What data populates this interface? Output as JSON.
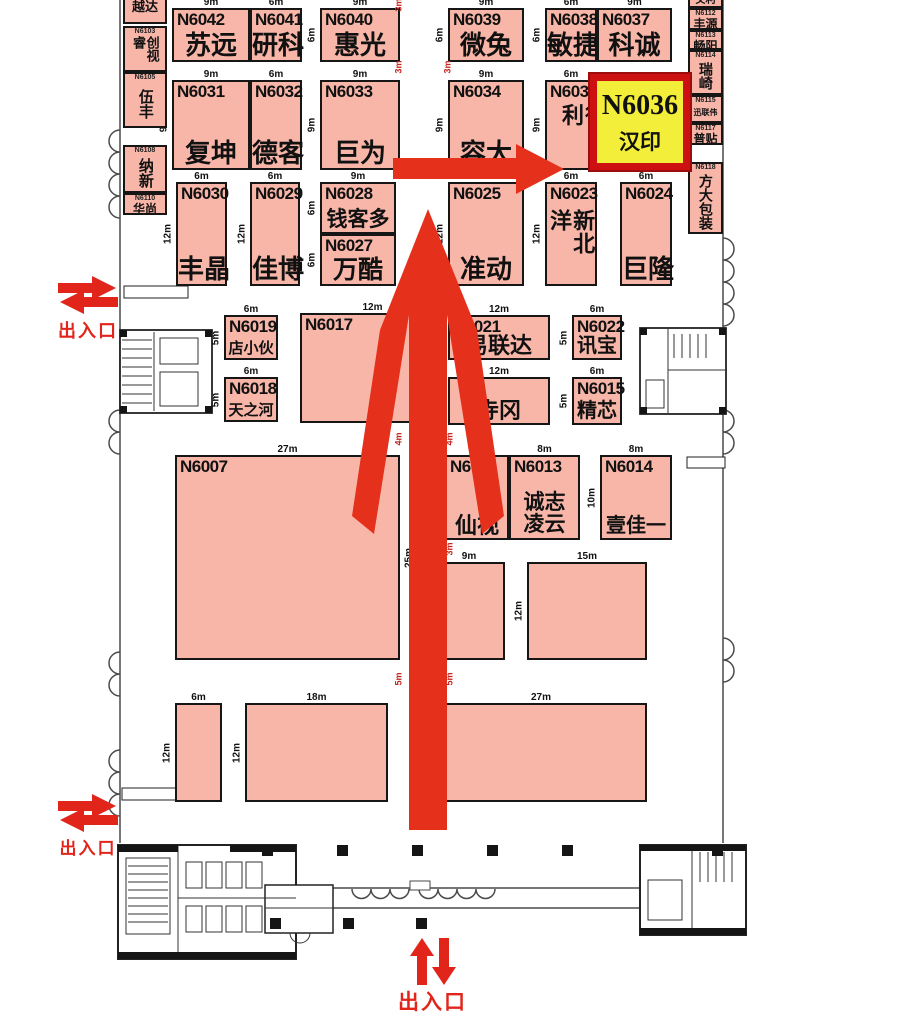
{
  "colors": {
    "booth_fill": "#f8b6a9",
    "booth_border": "#161616",
    "highlight_fill": "#f3ee39",
    "highlight_border": "#cd1111",
    "route_arrow": "#e5301b",
    "entrance_red": "#e1251b",
    "aisle_dim_red": "#c2231d",
    "dim_black": "#111111"
  },
  "highlight_booth": {
    "num": "N6036",
    "name": "汉印",
    "x": 590,
    "y": 74,
    "w": 100,
    "h": 96
  },
  "booths": [
    {
      "num": "N6042",
      "name": "苏远",
      "x": 172,
      "y": 8,
      "w": 78,
      "h": 54,
      "dw": "9m",
      "dh": "6m",
      "fs": 26
    },
    {
      "num": "N6041",
      "name": "研科",
      "x": 250,
      "y": 8,
      "w": 52,
      "h": 54,
      "dw": "6m",
      "fs": 26
    },
    {
      "num": "N6040",
      "name": "惠光",
      "x": 320,
      "y": 8,
      "w": 80,
      "h": 54,
      "dw": "9m",
      "dh": "6m",
      "fs": 26
    },
    {
      "num": "N6039",
      "name": "微兔",
      "x": 448,
      "y": 8,
      "w": 76,
      "h": 54,
      "dw": "9m",
      "dh": "6m",
      "fs": 26
    },
    {
      "num": "N6038",
      "name": "敏捷",
      "x": 545,
      "y": 8,
      "w": 52,
      "h": 54,
      "dw": "6m",
      "dh": "6m",
      "fs": 26
    },
    {
      "num": "N6037",
      "name": "科诚",
      "x": 597,
      "y": 8,
      "w": 75,
      "h": 54,
      "dw": "9m",
      "fs": 26
    },
    {
      "num": "N6031",
      "name": "复坤",
      "x": 172,
      "y": 80,
      "w": 78,
      "h": 90,
      "dw": "9m",
      "dh": "9m",
      "fs": 26
    },
    {
      "num": "N6032",
      "name": "德客",
      "x": 250,
      "y": 80,
      "w": 52,
      "h": 90,
      "dw": "6m",
      "fs": 26
    },
    {
      "num": "N6033",
      "name": "巨为",
      "x": 320,
      "y": 80,
      "w": 80,
      "h": 90,
      "dw": "9m",
      "dh": "9m",
      "fs": 26
    },
    {
      "num": "N6034",
      "name": "容大",
      "x": 448,
      "y": 80,
      "w": 76,
      "h": 90,
      "dw": "9m",
      "dh": "9m",
      "fs": 26
    },
    {
      "num": "N6035",
      "name": "得利",
      "x": 545,
      "y": 80,
      "w": 52,
      "h": 90,
      "dw": "6m",
      "dh": "9m",
      "fs": 22,
      "mode": "v",
      "shift": 12
    },
    {
      "num": "N6030",
      "name": "丰晶",
      "x": 176,
      "y": 182,
      "w": 51,
      "h": 104,
      "dw": "6m",
      "dh": "12m",
      "fs": 26
    },
    {
      "num": "N6029",
      "name": "佳博",
      "x": 250,
      "y": 182,
      "w": 50,
      "h": 104,
      "dw": "6m",
      "dh": "12m",
      "fs": 26
    },
    {
      "num": "N6028",
      "name": "钱客多",
      "x": 320,
      "y": 182,
      "w": 76,
      "h": 52,
      "dw": "9m",
      "dh": "6m",
      "fs": 21
    },
    {
      "num": "N6027",
      "name": "万酷",
      "x": 320,
      "y": 234,
      "w": 76,
      "h": 52,
      "dh": "6m",
      "fs": 25
    },
    {
      "num": "N6025",
      "name": "准动",
      "x": 448,
      "y": 182,
      "w": 76,
      "h": 104,
      "dw": "9m",
      "dh": "12m",
      "fs": 26
    },
    {
      "num": "N6023",
      "name": "新北洋",
      "x": 545,
      "y": 182,
      "w": 52,
      "h": 104,
      "dw": "6m",
      "dh": "12m",
      "fs": 22,
      "mode": "v"
    },
    {
      "num": "N6024",
      "name": "巨隆",
      "x": 620,
      "y": 182,
      "w": 52,
      "h": 104,
      "dw": "6m",
      "fs": 26
    },
    {
      "num": "N6019",
      "name": "店小伙",
      "x": 224,
      "y": 315,
      "w": 54,
      "h": 45,
      "dw": "6m",
      "dh": "5m",
      "fs": 15,
      "ns": 15
    },
    {
      "num": "N6018",
      "name": "天之河",
      "x": 224,
      "y": 377,
      "w": 54,
      "h": 45,
      "dw": "6m",
      "dh": "5m",
      "fs": 15,
      "ns": 15
    },
    {
      "num": "N6017",
      "name": "",
      "x": 300,
      "y": 313,
      "w": 145,
      "h": 110,
      "dw": "12m"
    },
    {
      "num": "N6021",
      "name": "易联达",
      "x": 448,
      "y": 315,
      "w": 102,
      "h": 45,
      "dw": "12m",
      "fs": 22
    },
    {
      "num": "N6022",
      "name": "讯宝",
      "x": 572,
      "y": 315,
      "w": 50,
      "h": 45,
      "dw": "6m",
      "dh": "5m",
      "fs": 20
    },
    {
      "num": "",
      "name": "寺冈",
      "x": 448,
      "y": 377,
      "w": 102,
      "h": 48,
      "dw": "12m",
      "fs": 22
    },
    {
      "num": "N6015",
      "name": "精芯",
      "x": 572,
      "y": 377,
      "w": 50,
      "h": 48,
      "dw": "6m",
      "dh": "5m",
      "fs": 20
    },
    {
      "num": "N6007",
      "name": "",
      "x": 175,
      "y": 455,
      "w": 225,
      "h": 205,
      "dw": "27m",
      "dh": "25m",
      "ds": "r"
    },
    {
      "num": "N60",
      "name": "仙视",
      "x": 445,
      "y": 455,
      "w": 64,
      "h": 85,
      "fs": 22
    },
    {
      "num": "N6013",
      "name": "诚志",
      "name2": "凌云",
      "x": 509,
      "y": 455,
      "w": 71,
      "h": 85,
      "dw": "8m",
      "fs": 21,
      "mode": "b2"
    },
    {
      "num": "N6014",
      "name": "壹佳一",
      "x": 600,
      "y": 455,
      "w": 72,
      "h": 85,
      "dw": "8m",
      "dh": "10m",
      "fs": 20
    }
  ],
  "open_blocks": [
    {
      "x": 433,
      "y": 562,
      "w": 72,
      "h": 98,
      "dw": "9m",
      "dh": "12m"
    },
    {
      "x": 527,
      "y": 562,
      "w": 120,
      "h": 98,
      "dw": "15m",
      "dh": "12m"
    },
    {
      "x": 175,
      "y": 703,
      "w": 47,
      "h": 99,
      "dw": "6m",
      "dh": "12m"
    },
    {
      "x": 245,
      "y": 703,
      "w": 143,
      "h": 99,
      "dw": "18m",
      "dh": "12m"
    },
    {
      "x": 435,
      "y": 703,
      "w": 212,
      "h": 99,
      "dw": "27m"
    }
  ],
  "sidebar_left": {
    "x": 123,
    "w": 44,
    "items": [
      {
        "num": "",
        "name": "越达",
        "y": -10,
        "h": 34,
        "o": "h",
        "fs": 13
      },
      {
        "num": "N6103",
        "name": "创视睿",
        "y": 26,
        "h": 46,
        "o": "v",
        "fs": 13
      },
      {
        "num": "N6105",
        "name": "伍丰",
        "y": 72,
        "h": 56,
        "o": "v",
        "fs": 15
      },
      {
        "num": "N6108",
        "name": "纳新",
        "y": 145,
        "h": 48,
        "o": "v",
        "fs": 15
      },
      {
        "num": "N6110",
        "name": "华尚",
        "y": 193,
        "h": 22,
        "o": "h",
        "fs": 12
      }
    ]
  },
  "sidebar_right": {
    "x": 688,
    "w": 35,
    "items": [
      {
        "num": "",
        "name": "文利",
        "y": -6,
        "h": 14,
        "o": "h",
        "fs": 10
      },
      {
        "num": "N6112",
        "name": "丰源",
        "y": 8,
        "h": 22,
        "o": "h",
        "fs": 12
      },
      {
        "num": "N6113",
        "name": "畅阳",
        "y": 30,
        "h": 20,
        "o": "h",
        "fs": 12
      },
      {
        "num": "N6114",
        "name": "瑞崎",
        "y": 50,
        "h": 45,
        "o": "v",
        "fs": 14
      },
      {
        "num": "N6115",
        "name": "迅联伟",
        "y": 95,
        "h": 28,
        "o": "h",
        "fs": 8
      },
      {
        "num": "N6117",
        "name": "普贴",
        "y": 123,
        "h": 22,
        "o": "h",
        "fs": 12
      },
      {
        "num": "N6118",
        "name": "方大包装",
        "y": 162,
        "h": 72,
        "o": "v",
        "fs": 14
      }
    ]
  },
  "aisle_labels": [
    {
      "t": "3m",
      "x": 392,
      "y": 0
    },
    {
      "t": "3m",
      "x": 392,
      "y": 62
    },
    {
      "t": "3m",
      "x": 441,
      "y": 62
    },
    {
      "t": "3m",
      "x": 392,
      "y": 162
    },
    {
      "t": "4m",
      "x": 392,
      "y": 434
    },
    {
      "t": "4m",
      "x": 443,
      "y": 434
    },
    {
      "t": "3m",
      "x": 443,
      "y": 544
    },
    {
      "t": "5m",
      "x": 392,
      "y": 674
    },
    {
      "t": "5m",
      "x": 443,
      "y": 674
    }
  ],
  "entrances": [
    {
      "label": "出入口",
      "orient": "h",
      "x": 56,
      "y": 274,
      "ls": 18
    },
    {
      "label": "出入口",
      "orient": "h",
      "x": 56,
      "y": 792,
      "ls": 17
    },
    {
      "label": "出入口",
      "orient": "v",
      "x": 398,
      "y": 936,
      "ls": 21
    }
  ]
}
